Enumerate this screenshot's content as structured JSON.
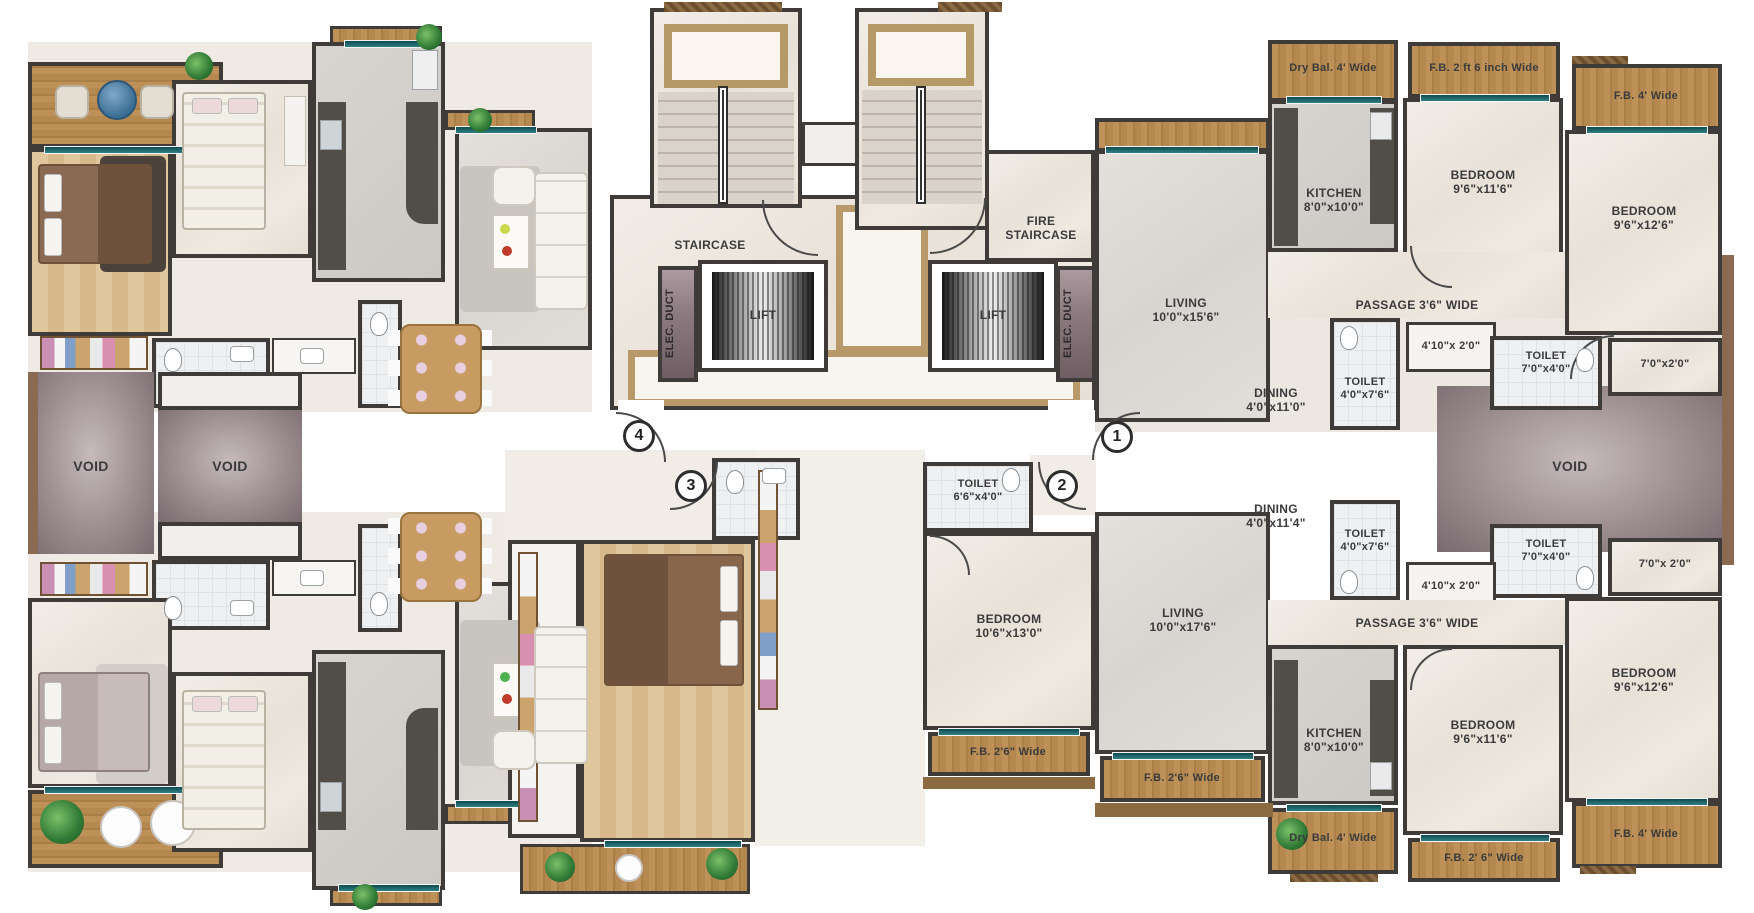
{
  "core": {
    "staircase": "STAIRCASE",
    "fire_staircase": "FIRE STAIRCASE",
    "lift": "LIFT",
    "elec_duct": "ELEC. DUCT",
    "void": "VOID"
  },
  "units": {
    "u1": "1",
    "u2": "2",
    "u3": "3",
    "u4": "4"
  },
  "u1": {
    "living": "LIVING",
    "living_dims": "10'0\"x15'6\"",
    "dining": "DINING",
    "dining_dims": "4'0\"x11'0\"",
    "toilet_a": "TOILET",
    "toilet_a_dims": "4'0\"x7'6\"",
    "niche_dims": "4'10\"x 2'0\"",
    "toilet_b": "TOILET",
    "toilet_b_dims": "7'0\"x4'0\"",
    "strip_dims": "7'0\"x2'0\"",
    "passage": "PASSAGE 3'6\" WIDE",
    "kitchen": "KITCHEN",
    "kitchen_dims": "8'0\"x10'0\"",
    "dry_bal": "Dry Bal. 4' Wide",
    "fb_26": "F.B. 2 ft 6 inch Wide",
    "bedroom_a": "BEDROOM",
    "bedroom_a_dims": "9'6\"x11'6\"",
    "fb_4": "F.B. 4' Wide",
    "bedroom_b": "BEDROOM",
    "bedroom_b_dims": "9'6\"x12'6\""
  },
  "u2": {
    "toilet_c": "TOILET",
    "toilet_c_dims": "6'6\"x4'0\"",
    "bedroom_c": "BEDROOM",
    "bedroom_c_dims": "10'6\"x13'0\"",
    "living": "LIVING",
    "living_dims": "10'0\"x17'6\"",
    "dining": "DINING",
    "dining_dims": "4'0\"x11'4\"",
    "toilet_a": "TOILET",
    "toilet_a_dims": "4'0\"x7'6\"",
    "niche_dims": "4'10\"x 2'0\"",
    "toilet_b": "TOILET",
    "toilet_b_dims": "7'0\"x4'0\"",
    "strip_dims": "7'0\"x 2'0\"",
    "passage": "PASSAGE 3'6\" WIDE",
    "kitchen": "KITCHEN",
    "kitchen_dims": "8'0\"x10'0\"",
    "bedroom_a": "BEDROOM",
    "bedroom_a_dims": "9'6\"x11'6\"",
    "bedroom_b": "BEDROOM",
    "bedroom_b_dims": "9'6\"x12'6\"",
    "fb_26_left": "F.B. 2'6\" Wide",
    "fb_26_mid": "F.B. 2'6\" Wide",
    "dry_bal": "Dry Bal. 4' Wide",
    "fb_26_b": "F.B. 2' 6\" Wide",
    "fb_4": "F.B. 4' Wide"
  },
  "colors": {
    "wall": "#3f3b38",
    "gold_inlay": "#b7996a",
    "window_teal": "#1c6165",
    "void": "#7e6e72",
    "balcony_wood": "#b5884f",
    "label_text": "#3b3b3b"
  }
}
